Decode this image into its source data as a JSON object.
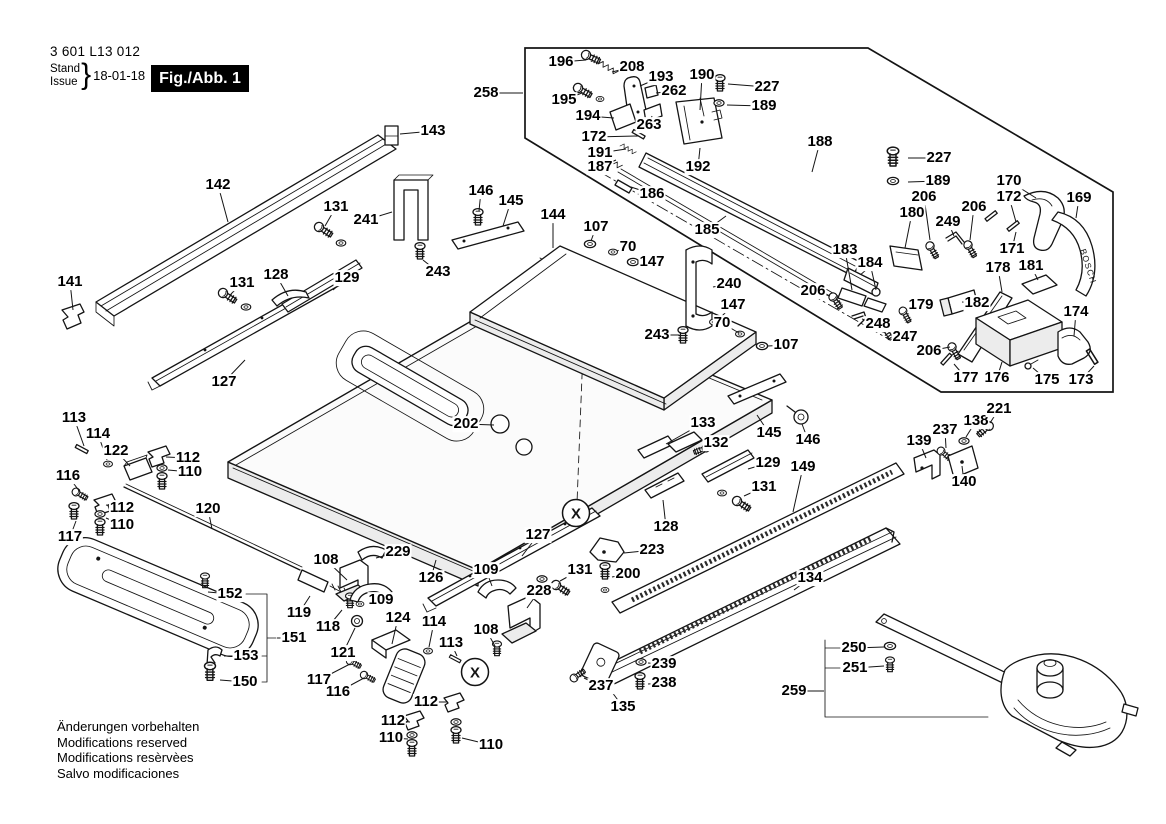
{
  "header": {
    "part_number": "3 601 L13 012",
    "stand_label": "Stand",
    "issue_label": "Issue",
    "brace": "}",
    "date": "18-01-18",
    "figure_label": "Fig./Abb. 1"
  },
  "footer": {
    "lines": [
      "Änderungen vorbehalten",
      "Modifications reserved",
      "Modifications resèrvèes",
      "Salvo modificaciones"
    ]
  },
  "diagram": {
    "detail_marker": "X",
    "brand_text": "BOSCH",
    "markers": [
      {
        "x": 576,
        "y": 513
      },
      {
        "x": 475,
        "y": 672
      }
    ],
    "callouts": [
      {
        "t": "258",
        "x": 486,
        "y": 93,
        "tx": 523,
        "ty": 93
      },
      {
        "t": "196",
        "x": 561,
        "y": 62,
        "tx": 586,
        "ty": 60
      },
      {
        "t": "208",
        "x": 632,
        "y": 67,
        "tx": 612,
        "ty": 72
      },
      {
        "t": "193",
        "x": 661,
        "y": 77,
        "tx": 640,
        "ty": 86
      },
      {
        "t": "190",
        "x": 702,
        "y": 75,
        "tx": 700,
        "ty": 110
      },
      {
        "t": "227",
        "x": 767,
        "y": 87,
        "tx": 728,
        "ty": 84
      },
      {
        "t": "262",
        "x": 674,
        "y": 91,
        "tx": 656,
        "ty": 93
      },
      {
        "t": "189",
        "x": 764,
        "y": 106,
        "tx": 727,
        "ty": 105
      },
      {
        "t": "195",
        "x": 564,
        "y": 100,
        "tx": 582,
        "ty": 93
      },
      {
        "t": "194",
        "x": 588,
        "y": 116,
        "tx": 614,
        "ty": 118
      },
      {
        "t": "263",
        "x": 649,
        "y": 125,
        "tx": 652,
        "ty": 116
      },
      {
        "t": "172",
        "x": 594,
        "y": 137,
        "tx": 638,
        "ty": 136
      },
      {
        "t": "191",
        "x": 600,
        "y": 153,
        "tx": 626,
        "ty": 149
      },
      {
        "t": "187",
        "x": 600,
        "y": 167,
        "tx": 616,
        "ty": 160
      },
      {
        "t": "192",
        "x": 698,
        "y": 167,
        "tx": 700,
        "ty": 148
      },
      {
        "t": "186",
        "x": 652,
        "y": 194,
        "tx": 631,
        "ty": 187
      },
      {
        "t": "188",
        "x": 820,
        "y": 142,
        "tx": 812,
        "ty": 172
      },
      {
        "t": "185",
        "x": 707,
        "y": 230,
        "tx": 726,
        "ty": 216
      },
      {
        "t": "227",
        "x": 939,
        "y": 158,
        "tx": 908,
        "ty": 158
      },
      {
        "t": "189",
        "x": 938,
        "y": 181,
        "tx": 908,
        "ty": 182
      },
      {
        "t": "206",
        "x": 924,
        "y": 197,
        "tx": 930,
        "ty": 240
      },
      {
        "t": "180",
        "x": 912,
        "y": 213,
        "tx": 905,
        "ty": 248
      },
      {
        "t": "249",
        "x": 948,
        "y": 222,
        "tx": 954,
        "ty": 236
      },
      {
        "t": "183",
        "x": 845,
        "y": 250,
        "tx": 852,
        "ty": 290
      },
      {
        "t": "184",
        "x": 870,
        "y": 263,
        "tx": 876,
        "ty": 290
      },
      {
        "t": "206",
        "x": 813,
        "y": 291,
        "tx": 830,
        "ty": 296
      },
      {
        "t": "248",
        "x": 878,
        "y": 324,
        "tx": 862,
        "ty": 319
      },
      {
        "t": "247",
        "x": 905,
        "y": 337,
        "tx": 888,
        "ty": 330
      },
      {
        "t": "179",
        "x": 921,
        "y": 305,
        "tx": 907,
        "ty": 314
      },
      {
        "t": "206",
        "x": 929,
        "y": 351,
        "tx": 950,
        "ty": 347
      },
      {
        "t": "170",
        "x": 1009,
        "y": 181,
        "tx": 1036,
        "ty": 198
      },
      {
        "t": "172",
        "x": 1009,
        "y": 197,
        "tx": 1016,
        "ty": 222
      },
      {
        "t": "169",
        "x": 1079,
        "y": 198,
        "tx": 1076,
        "ty": 218
      },
      {
        "t": "206",
        "x": 974,
        "y": 207,
        "tx": 970,
        "ty": 240
      },
      {
        "t": "171",
        "x": 1012,
        "y": 249,
        "tx": 1016,
        "ty": 232
      },
      {
        "t": "178",
        "x": 998,
        "y": 268,
        "tx": 1002,
        "ty": 292
      },
      {
        "t": "181",
        "x": 1031,
        "y": 266,
        "tx": 1038,
        "ty": 280
      },
      {
        "t": "182",
        "x": 977,
        "y": 303,
        "tx": 962,
        "ty": 302
      },
      {
        "t": "174",
        "x": 1076,
        "y": 312,
        "tx": 1074,
        "ty": 336
      },
      {
        "t": "177",
        "x": 966,
        "y": 378,
        "tx": 954,
        "ty": 364
      },
      {
        "t": "176",
        "x": 997,
        "y": 378,
        "tx": 1002,
        "ty": 362
      },
      {
        "t": "175",
        "x": 1047,
        "y": 380,
        "tx": 1033,
        "ty": 368
      },
      {
        "t": "173",
        "x": 1081,
        "y": 380,
        "tx": 1094,
        "ty": 366
      },
      {
        "t": "143",
        "x": 433,
        "y": 131,
        "tx": 400,
        "ty": 134
      },
      {
        "t": "142",
        "x": 218,
        "y": 185,
        "tx": 228,
        "ty": 222
      },
      {
        "t": "141",
        "x": 70,
        "y": 282,
        "tx": 73,
        "ty": 310
      },
      {
        "t": "131",
        "x": 336,
        "y": 207,
        "tx": 325,
        "ty": 226
      },
      {
        "t": "241",
        "x": 366,
        "y": 220,
        "tx": 392,
        "ty": 212
      },
      {
        "t": "129",
        "x": 347,
        "y": 278,
        "tx": 333,
        "ty": 290
      },
      {
        "t": "128",
        "x": 276,
        "y": 275,
        "tx": 288,
        "ty": 296
      },
      {
        "t": "131",
        "x": 242,
        "y": 283,
        "tx": 231,
        "ty": 294
      },
      {
        "t": "127",
        "x": 224,
        "y": 382,
        "tx": 245,
        "ty": 360
      },
      {
        "t": "146",
        "x": 481,
        "y": 191,
        "tx": 479,
        "ty": 211
      },
      {
        "t": "145",
        "x": 511,
        "y": 201,
        "tx": 503,
        "ty": 226
      },
      {
        "t": "144",
        "x": 553,
        "y": 215,
        "tx": 553,
        "ty": 248
      },
      {
        "t": "107",
        "x": 596,
        "y": 227,
        "tx": 591,
        "ty": 241
      },
      {
        "t": "70",
        "x": 628,
        "y": 247,
        "tx": 617,
        "ty": 251
      },
      {
        "t": "147",
        "x": 652,
        "y": 262,
        "tx": 637,
        "ty": 262
      },
      {
        "t": "243",
        "x": 438,
        "y": 272,
        "tx": 423,
        "ty": 260
      },
      {
        "t": "240",
        "x": 729,
        "y": 284,
        "tx": 713,
        "ty": 287
      },
      {
        "t": "147",
        "x": 733,
        "y": 305,
        "tx": 717,
        "ty": 321
      },
      {
        "t": "70",
        "x": 722,
        "y": 323,
        "tx": 739,
        "ty": 333
      },
      {
        "t": "107",
        "x": 786,
        "y": 345,
        "tx": 768,
        "ty": 346
      },
      {
        "t": "243",
        "x": 657,
        "y": 335,
        "tx": 679,
        "ty": 335
      },
      {
        "t": "202",
        "x": 466,
        "y": 424,
        "tx": 494,
        "ty": 425
      },
      {
        "t": "113",
        "x": 74,
        "y": 418,
        "tx": 84,
        "ty": 446
      },
      {
        "t": "114",
        "x": 98,
        "y": 434,
        "tx": 107,
        "ty": 460
      },
      {
        "t": "122",
        "x": 116,
        "y": 451,
        "tx": 130,
        "ty": 466
      },
      {
        "t": "112",
        "x": 188,
        "y": 458,
        "tx": 166,
        "ty": 457
      },
      {
        "t": "110",
        "x": 190,
        "y": 472,
        "tx": 168,
        "ty": 470
      },
      {
        "t": "116",
        "x": 68,
        "y": 476,
        "tx": 80,
        "ty": 492
      },
      {
        "t": "112",
        "x": 122,
        "y": 508,
        "tx": 106,
        "ty": 505
      },
      {
        "t": "110",
        "x": 122,
        "y": 525,
        "tx": 106,
        "ty": 518
      },
      {
        "t": "117",
        "x": 70,
        "y": 537,
        "tx": 76,
        "ty": 521
      },
      {
        "t": "120",
        "x": 208,
        "y": 509,
        "tx": 212,
        "ty": 529
      },
      {
        "t": "108",
        "x": 326,
        "y": 560,
        "tx": 347,
        "ty": 580
      },
      {
        "t": "229",
        "x": 398,
        "y": 552,
        "tx": 376,
        "ty": 558
      },
      {
        "t": "126",
        "x": 431,
        "y": 578,
        "tx": 436,
        "ty": 560
      },
      {
        "t": "109",
        "x": 381,
        "y": 600,
        "tx": 370,
        "ty": 594
      },
      {
        "t": "119",
        "x": 299,
        "y": 613,
        "tx": 310,
        "ty": 596
      },
      {
        "t": "118",
        "x": 328,
        "y": 627,
        "tx": 342,
        "ty": 610
      },
      {
        "t": "121",
        "x": 343,
        "y": 653,
        "tx": 355,
        "ty": 628
      },
      {
        "t": "124",
        "x": 398,
        "y": 618,
        "tx": 392,
        "ty": 644
      },
      {
        "t": "114",
        "x": 434,
        "y": 622,
        "tx": 429,
        "ty": 647
      },
      {
        "t": "113",
        "x": 451,
        "y": 643,
        "tx": 457,
        "ty": 656
      },
      {
        "t": "117",
        "x": 319,
        "y": 680,
        "tx": 350,
        "ty": 664
      },
      {
        "t": "116",
        "x": 338,
        "y": 692,
        "tx": 364,
        "ty": 678
      },
      {
        "t": "112",
        "x": 426,
        "y": 702,
        "tx": 448,
        "ty": 702
      },
      {
        "t": "112",
        "x": 393,
        "y": 721,
        "tx": 410,
        "ty": 722
      },
      {
        "t": "110",
        "x": 391,
        "y": 738,
        "tx": 408,
        "ty": 739
      },
      {
        "t": "110",
        "x": 491,
        "y": 745,
        "tx": 462,
        "ty": 738
      },
      {
        "t": "152",
        "x": 230,
        "y": 594,
        "tx": 208,
        "ty": 592
      },
      {
        "t": "151",
        "x": 294,
        "y": 638,
        "tx": 277,
        "ty": 638
      },
      {
        "t": "153",
        "x": 246,
        "y": 656,
        "tx": 224,
        "ty": 656
      },
      {
        "t": "150",
        "x": 245,
        "y": 682,
        "tx": 220,
        "ty": 680
      },
      {
        "t": "127",
        "x": 538,
        "y": 535,
        "tx": 522,
        "ty": 556
      },
      {
        "t": "131",
        "x": 580,
        "y": 570,
        "tx": 560,
        "ty": 581
      },
      {
        "t": "223",
        "x": 652,
        "y": 550,
        "tx": 624,
        "ty": 553
      },
      {
        "t": "200",
        "x": 628,
        "y": 574,
        "tx": 612,
        "ty": 577
      },
      {
        "t": "128",
        "x": 666,
        "y": 527,
        "tx": 663,
        "ty": 500
      },
      {
        "t": "228",
        "x": 539,
        "y": 591,
        "tx": 527,
        "ty": 608
      },
      {
        "t": "109",
        "x": 486,
        "y": 570,
        "tx": 492,
        "ty": 586
      },
      {
        "t": "108",
        "x": 486,
        "y": 630,
        "tx": 495,
        "ty": 646
      },
      {
        "t": "239",
        "x": 664,
        "y": 664,
        "tx": 648,
        "ty": 663
      },
      {
        "t": "238",
        "x": 664,
        "y": 683,
        "tx": 648,
        "ty": 684
      },
      {
        "t": "237",
        "x": 601,
        "y": 686,
        "tx": 584,
        "ty": 678
      },
      {
        "t": "135",
        "x": 623,
        "y": 707,
        "tx": 606,
        "ty": 684
      },
      {
        "t": "134",
        "x": 810,
        "y": 578,
        "tx": 794,
        "ty": 590
      },
      {
        "t": "149",
        "x": 803,
        "y": 467,
        "tx": 793,
        "ty": 512
      },
      {
        "t": "131",
        "x": 764,
        "y": 487,
        "tx": 744,
        "ty": 496
      },
      {
        "t": "129",
        "x": 768,
        "y": 463,
        "tx": 748,
        "ty": 469
      },
      {
        "t": "133",
        "x": 703,
        "y": 423,
        "tx": 666,
        "ty": 444
      },
      {
        "t": "132",
        "x": 716,
        "y": 443,
        "tx": 702,
        "ty": 450
      },
      {
        "t": "145",
        "x": 769,
        "y": 433,
        "tx": 757,
        "ty": 415
      },
      {
        "t": "146",
        "x": 808,
        "y": 440,
        "tx": 802,
        "ty": 424
      },
      {
        "t": "139",
        "x": 919,
        "y": 441,
        "tx": 926,
        "ty": 458
      },
      {
        "t": "237",
        "x": 945,
        "y": 430,
        "tx": 946,
        "ty": 448
      },
      {
        "t": "138",
        "x": 976,
        "y": 421,
        "tx": 966,
        "ty": 437
      },
      {
        "t": "221",
        "x": 999,
        "y": 409,
        "tx": 990,
        "ty": 423
      },
      {
        "t": "140",
        "x": 964,
        "y": 482,
        "tx": 962,
        "ty": 466
      },
      {
        "t": "259",
        "x": 794,
        "y": 691,
        "tx": 824,
        "ty": 691
      },
      {
        "t": "250",
        "x": 854,
        "y": 648,
        "tx": 884,
        "ty": 647
      },
      {
        "t": "251",
        "x": 855,
        "y": 668,
        "tx": 884,
        "ty": 666
      }
    ]
  }
}
